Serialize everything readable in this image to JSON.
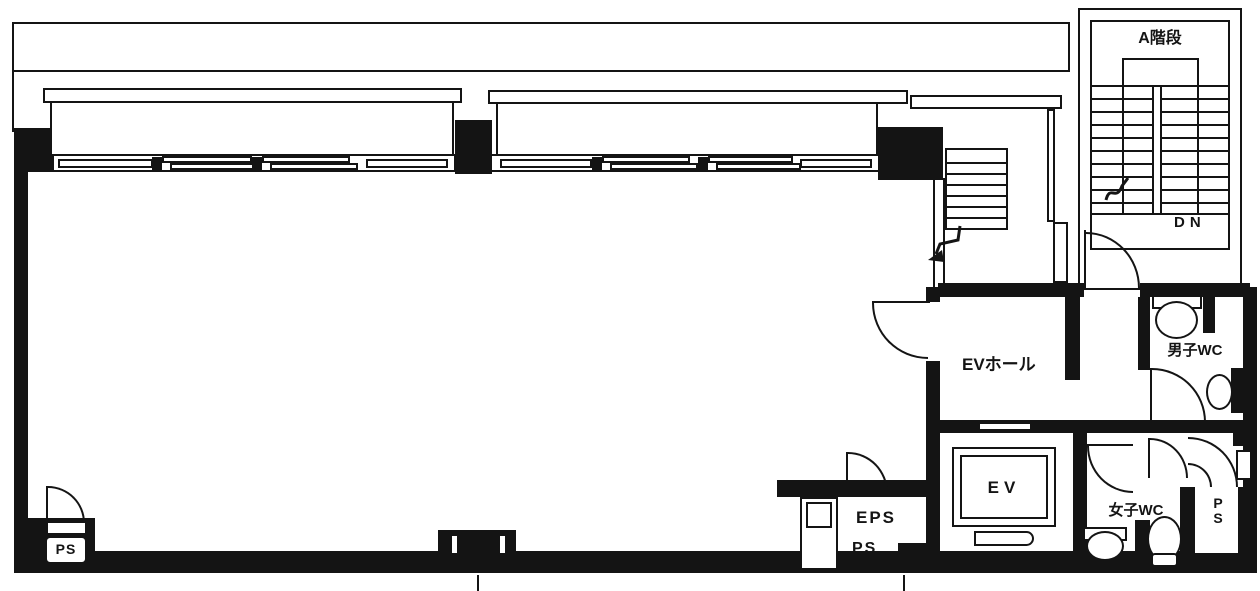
{
  "plan": {
    "type": "floor-plan",
    "colors": {
      "ink": "#141414",
      "paper": "#ffffff"
    },
    "labels": {
      "stair_a": "A階段",
      "down": "DN",
      "ev_hall": "EVホール",
      "elevator": "EV",
      "mens_wc": "男子WC",
      "womens_wc": "女子WC",
      "eps": "EPS",
      "ps_center": "PS",
      "ps_bottom_left": "PS",
      "ps_right_shaft": "PS"
    }
  }
}
